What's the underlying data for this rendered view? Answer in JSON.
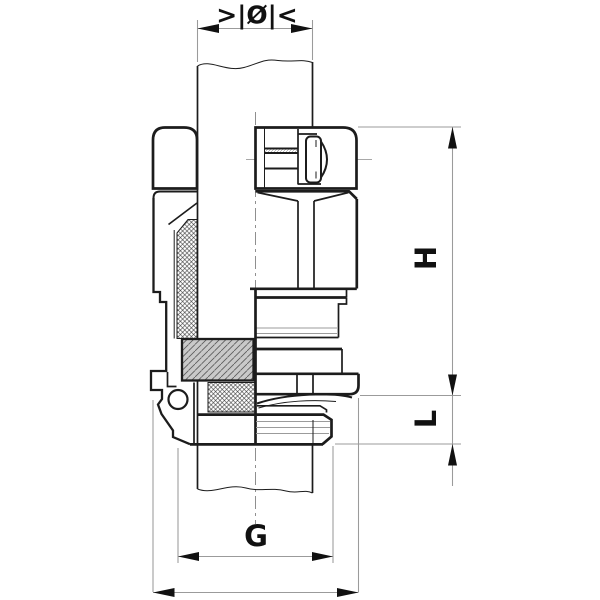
{
  "drawing": {
    "labels": {
      "diameter": ">|Ø|<",
      "height": "H",
      "thread_length": "L",
      "thread_size": "G"
    },
    "colors": {
      "outline": "#1c1c1c",
      "dimension_lines": "#9b9b9b",
      "centerline": "#8f8f8f",
      "panel_fill": "#c9c9c9",
      "background": "#ffffff"
    }
  }
}
